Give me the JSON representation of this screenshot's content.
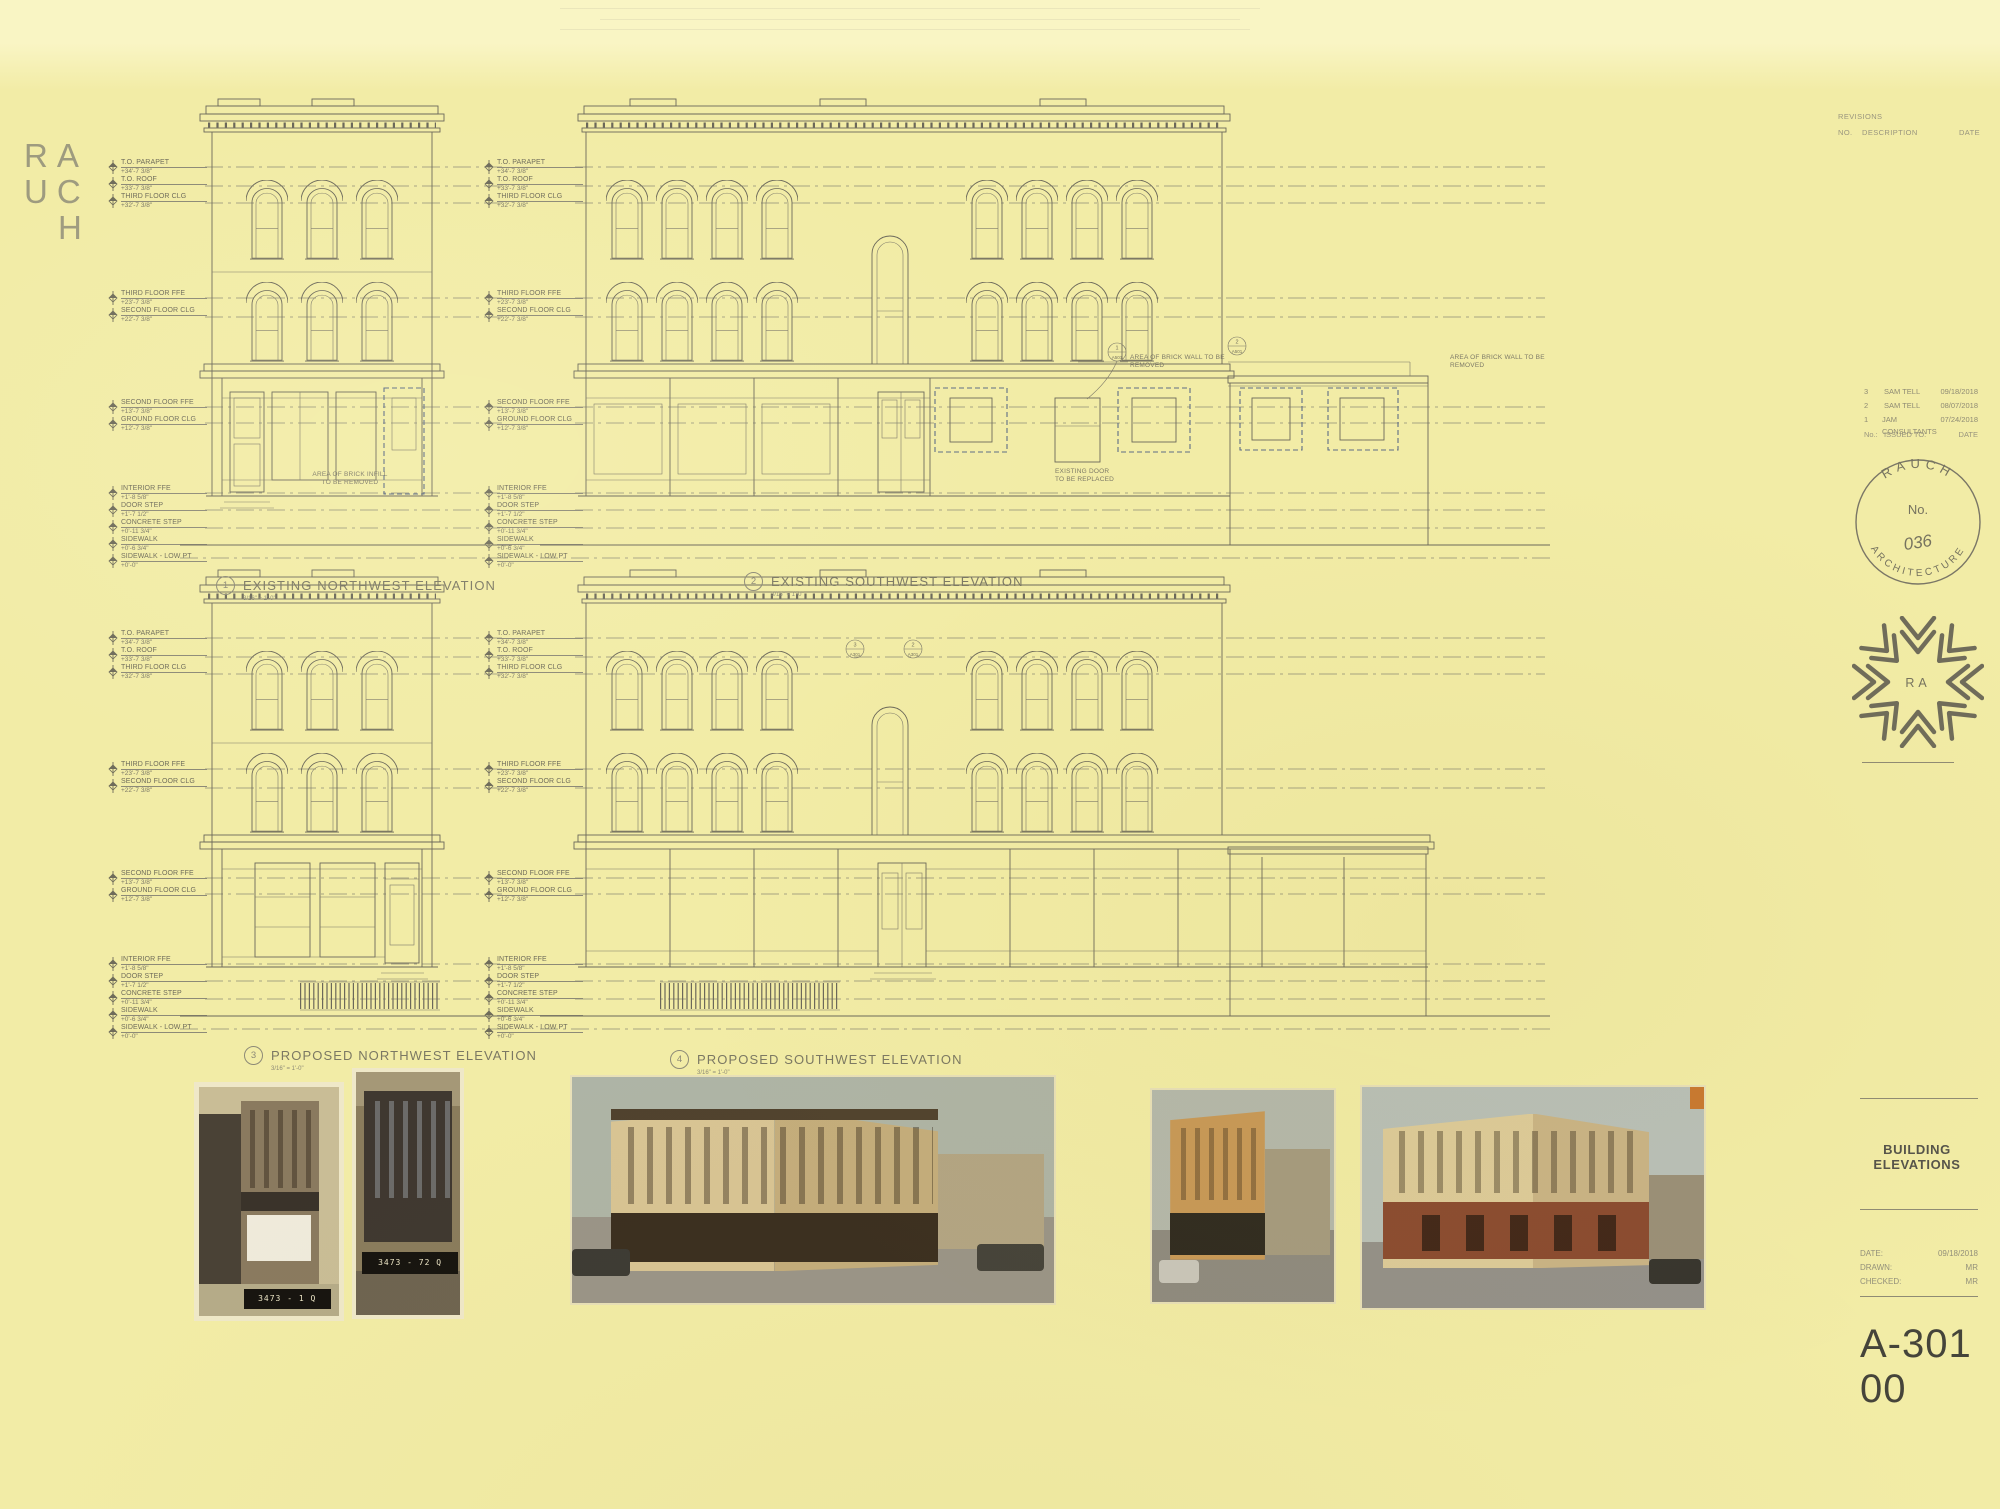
{
  "logo": {
    "l1": "RA",
    "l2": "UC",
    "l3": "H"
  },
  "levels_g1": [
    {
      "name": "T.O. PARAPET",
      "elev": "+34'-7 3/8\""
    },
    {
      "name": "T.O. ROOF",
      "elev": "+33'-7 3/8\""
    },
    {
      "name": "THIRD FLOOR CLG",
      "elev": "+32'-7 3/8\""
    }
  ],
  "levels_g2": [
    {
      "name": "THIRD FLOOR FFE",
      "elev": "+23'-7 3/8\""
    },
    {
      "name": "SECOND FLOOR CLG",
      "elev": "+22'-7 3/8\""
    }
  ],
  "levels_g3": [
    {
      "name": "SECOND FLOOR FFE",
      "elev": "+13'-7 3/8\""
    },
    {
      "name": "GROUND FLOOR CLG",
      "elev": "+12'-7 3/8\""
    }
  ],
  "levels_g4": [
    {
      "name": "INTERIOR FFE",
      "elev": "+1'-8 5/8\""
    },
    {
      "name": "DOOR STEP",
      "elev": "+1'-7 1/2\""
    },
    {
      "name": "CONCRETE STEP",
      "elev": "+0'-11 3/4\""
    },
    {
      "name": "SIDEWALK",
      "elev": "+0'-6 3/4\""
    },
    {
      "name": "SIDEWALK - LOW PT",
      "elev": "+0'-0\""
    }
  ],
  "drawings": [
    {
      "num": "1",
      "title": "EXISTING NORTHWEST ELEVATION",
      "scale": "3/16\" = 1'-0\""
    },
    {
      "num": "2",
      "title": "EXISTING SOUTHWEST ELEVATION",
      "scale": "3/16\" = 1'-0\""
    },
    {
      "num": "3",
      "title": "PROPOSED NORTHWEST ELEVATION",
      "scale": "3/16\" = 1'-0\""
    },
    {
      "num": "4",
      "title": "PROPOSED SOUTHWEST ELEVATION",
      "scale": "3/16\" = 1'-0\""
    }
  ],
  "notes": {
    "brick_infill": "AREA OF BRICK INFILL\nTO BE REMOVED",
    "brick_wall": "AREA OF BRICK WALL TO BE REMOVED",
    "door_replace": "EXISTING DOOR\nTO BE REPLACED"
  },
  "refs": {
    "r1": {
      "num": "1",
      "sheet": "A501"
    },
    "r2": {
      "num": "2",
      "sheet": "A501"
    },
    "r3": {
      "num": "3",
      "sheet": "A301"
    },
    "r4": {
      "num": "2",
      "sheet": "A301"
    }
  },
  "titleblock": {
    "revisions": "REVISIONS",
    "col_no": "NO.",
    "col_desc": "DESCRIPTION",
    "col_date": "DATE",
    "issue_head": {
      "no": "No.:",
      "to": "ISSUED TO:",
      "date": "DATE"
    },
    "sheet_title": "BUILDING ELEVATIONS",
    "sheet_number": "A-301 00"
  },
  "issues": [
    {
      "no": "3",
      "to": "SAM TELL",
      "date": "09/18/2018"
    },
    {
      "no": "2",
      "to": "SAM TELL",
      "date": "08/07/2018"
    },
    {
      "no": "1",
      "to": "JAM CONSULTANTS",
      "date": "07/24/2018"
    }
  ],
  "meta": [
    {
      "label": "DATE:",
      "value": "09/18/2018"
    },
    {
      "label": "DRAWN:",
      "value": "MR"
    },
    {
      "label": "CHECKED:",
      "value": "MR"
    }
  ],
  "stamp": {
    "arc_top": "RAUCH",
    "no_label": "No.",
    "number": "036",
    "arc_bottom": "ARCHITECTURE",
    "mark_letters": "RA"
  },
  "photos": {
    "tag1": "3473 - 1 Q",
    "tag2": "3473 - 72 Q"
  }
}
